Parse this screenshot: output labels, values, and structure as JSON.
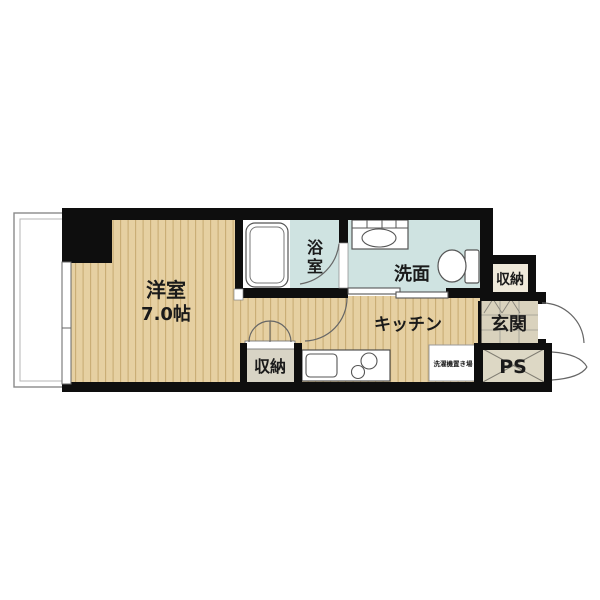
{
  "floorplan": {
    "title": "1K apartment floor plan",
    "rooms": {
      "living": {
        "label": "洋室",
        "size": "7.0帖"
      },
      "bath": {
        "label": "浴室",
        "label_chars": [
          "浴",
          "室"
        ]
      },
      "washroom": {
        "label": "洗面"
      },
      "kitchen": {
        "label": "キッチン"
      },
      "closet_lower": {
        "label": "収納"
      },
      "closet_entry": {
        "label": "収納"
      },
      "entrance": {
        "label": "玄関"
      },
      "pipe_space": {
        "label": "PS"
      },
      "laundry": {
        "label": "洗濯機置き場"
      }
    },
    "colors": {
      "wood_floor": "#e6d0a2",
      "wood_stripe": "#c9ad74",
      "wet_area_floor": "#cfe3e1",
      "entrance_tile": "#d9d2bd",
      "pipe_space_fill": "#ddd8c5",
      "closet_fill": "#d8d4c5",
      "wall": "#0e0e0e",
      "background": "#ffffff"
    }
  }
}
